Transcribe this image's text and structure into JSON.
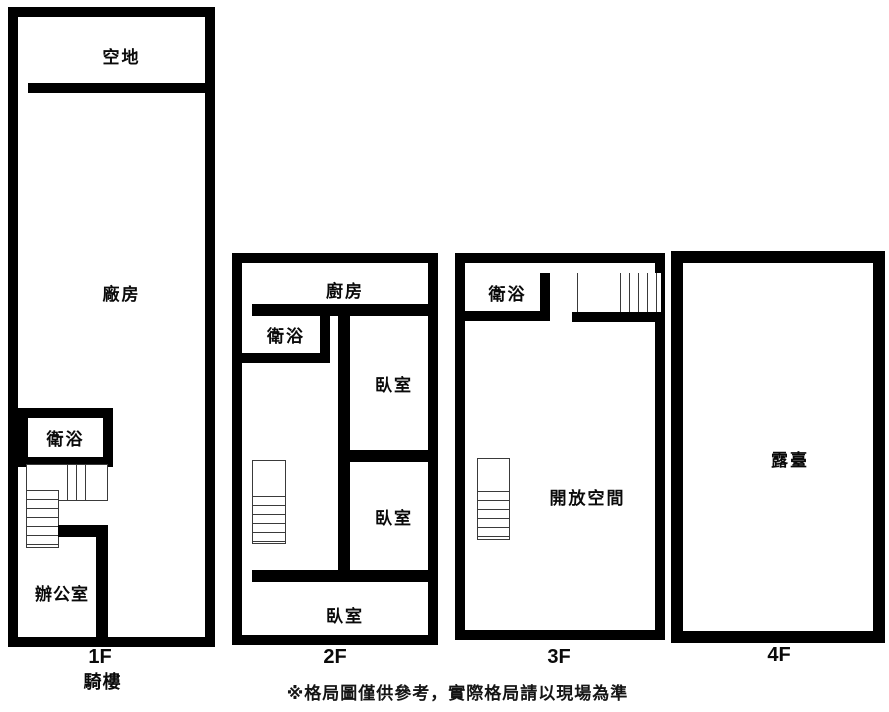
{
  "colors": {
    "wall": "#000000",
    "background": "#ffffff",
    "stair_line": "#3a3a3a",
    "text": "#0a0a0a"
  },
  "floors": [
    {
      "label": "1F",
      "sublabel": "騎樓",
      "rooms": [
        {
          "name": "vacant-lot",
          "label": "空地"
        },
        {
          "name": "factory",
          "label": "廠房"
        },
        {
          "name": "bathroom",
          "label": "衛浴"
        },
        {
          "name": "office",
          "label": "辦公室"
        }
      ]
    },
    {
      "label": "2F",
      "rooms": [
        {
          "name": "kitchen",
          "label": "廚房"
        },
        {
          "name": "bathroom",
          "label": "衛浴"
        },
        {
          "name": "bedroom-top",
          "label": "臥室"
        },
        {
          "name": "bedroom-middle",
          "label": "臥室"
        },
        {
          "name": "bedroom-bottom",
          "label": "臥室"
        }
      ]
    },
    {
      "label": "3F",
      "rooms": [
        {
          "name": "bathroom",
          "label": "衛浴"
        },
        {
          "name": "open-space",
          "label": "開放空間"
        }
      ]
    },
    {
      "label": "4F",
      "rooms": [
        {
          "name": "terrace",
          "label": "露臺"
        }
      ]
    }
  ],
  "disclaimer": "※格局圖僅供參考，實際格局請以現場為準"
}
